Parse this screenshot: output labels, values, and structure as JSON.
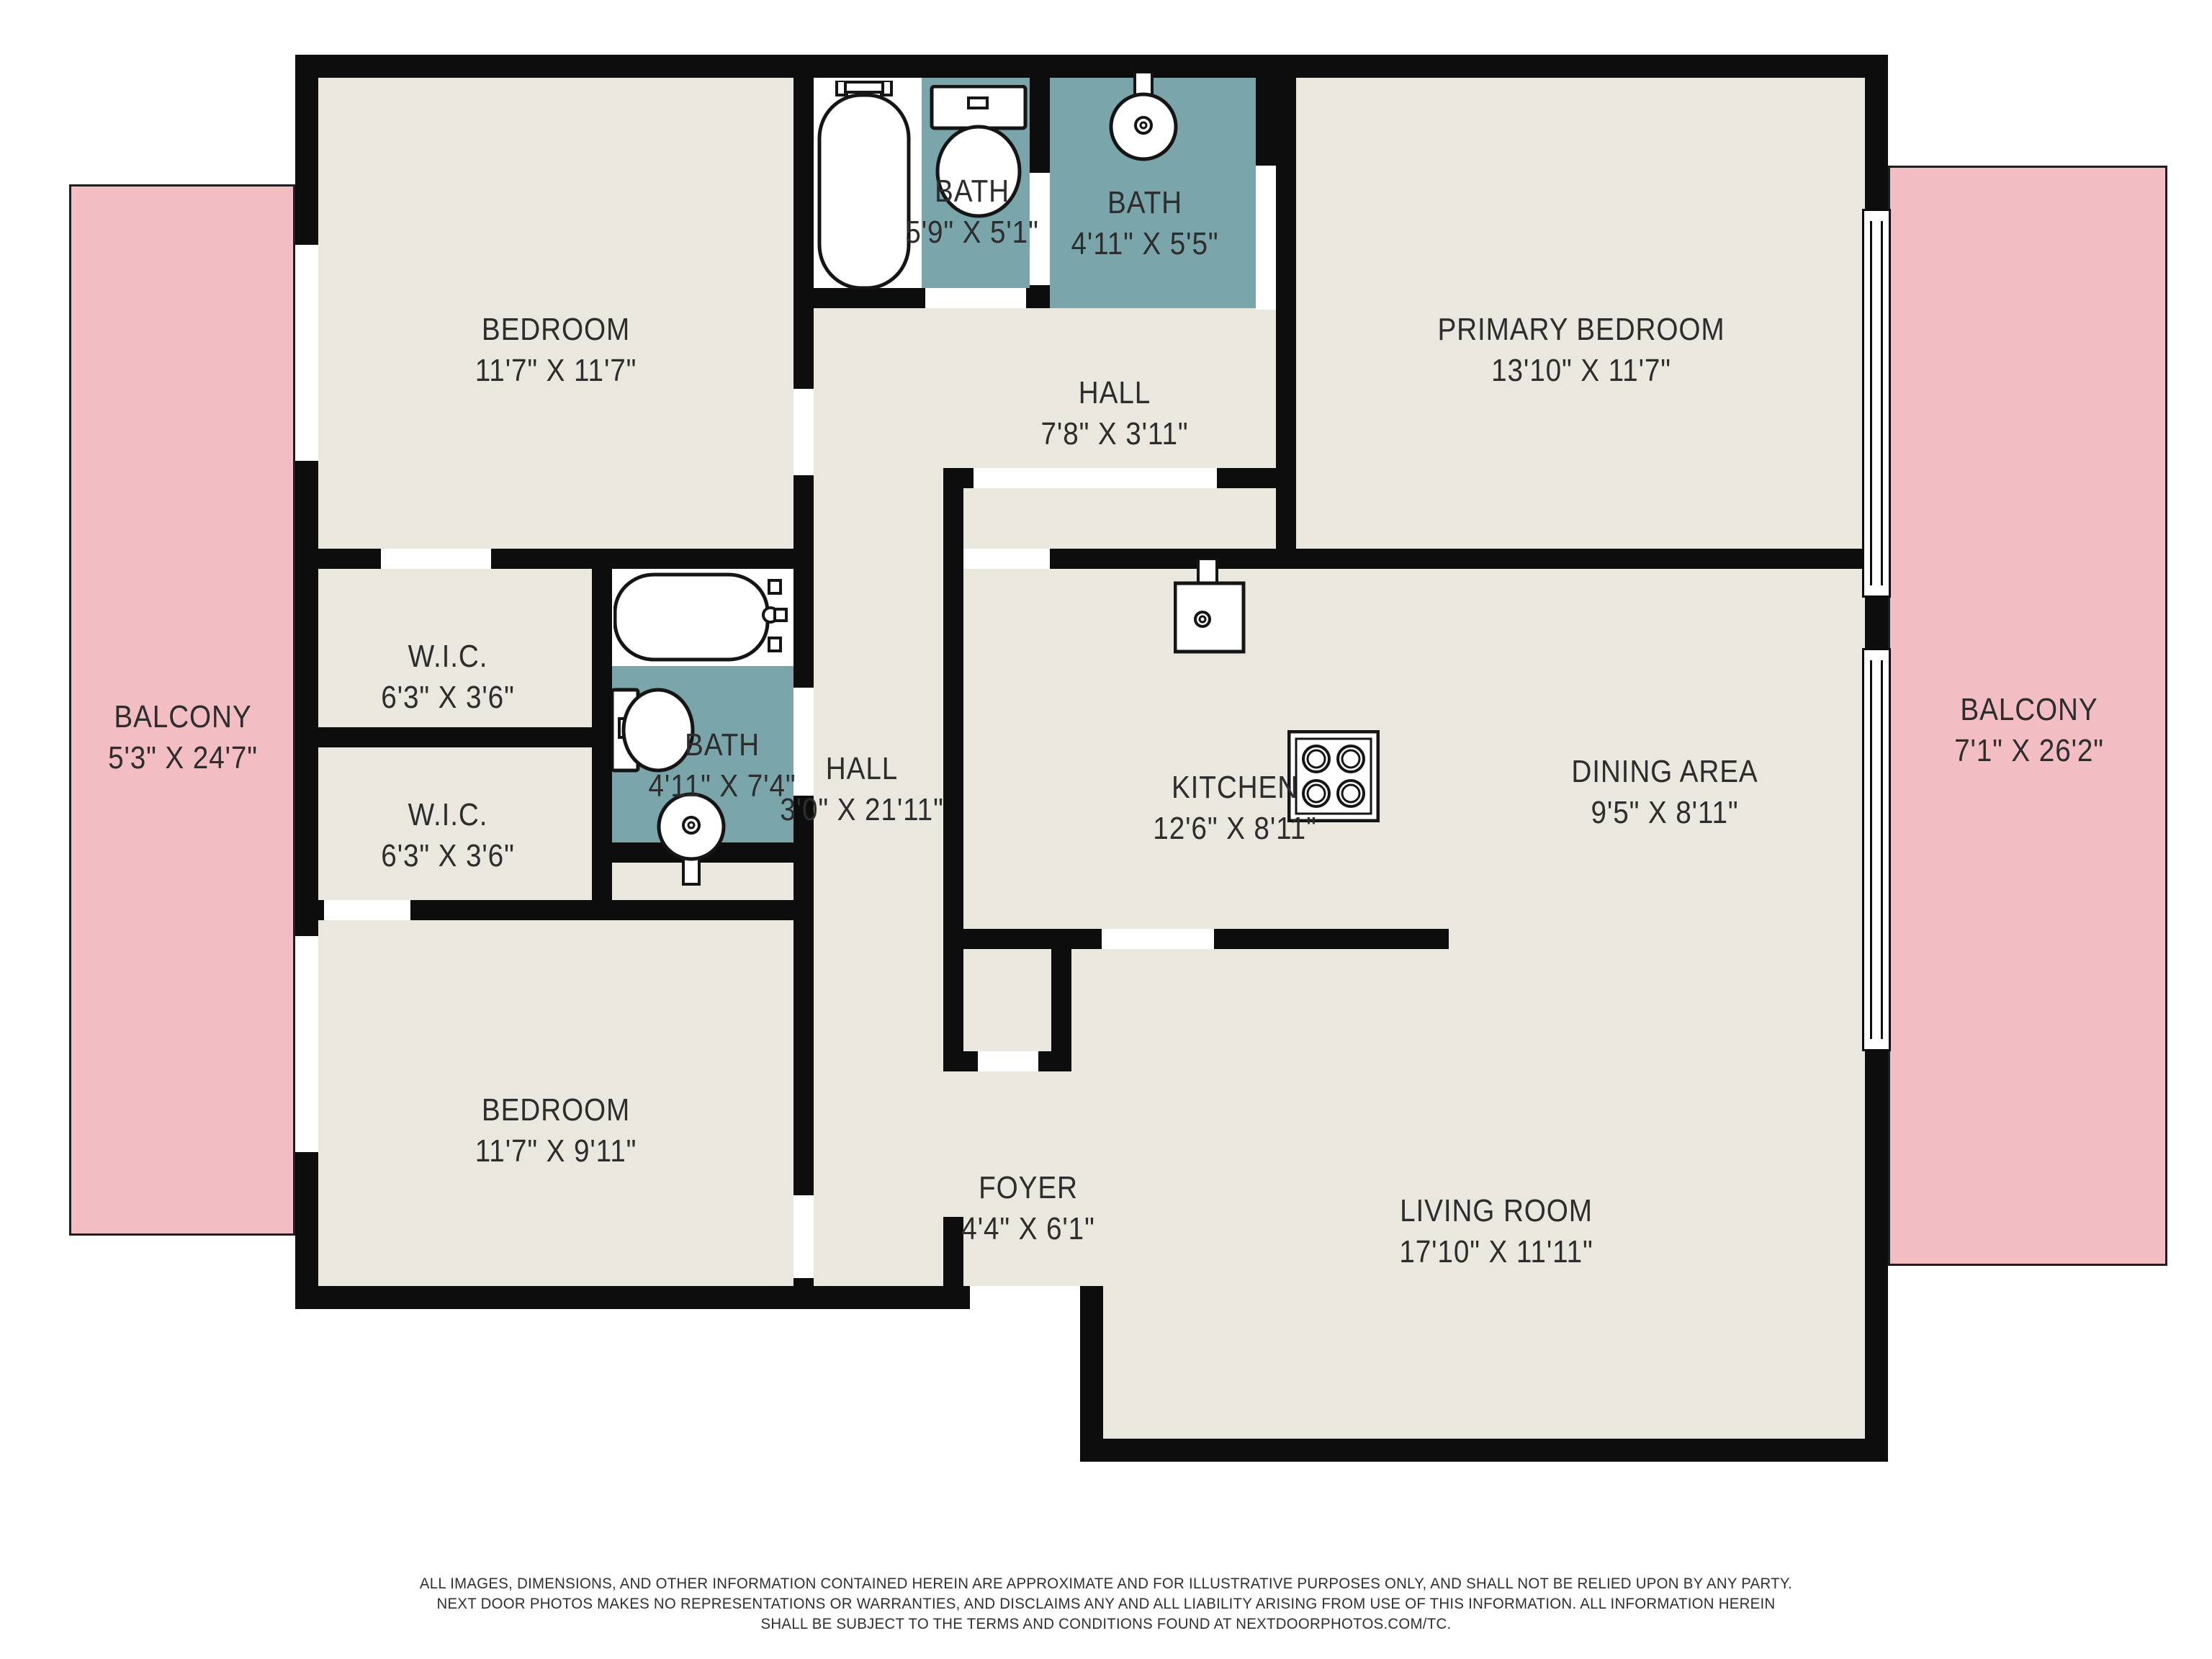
{
  "colors": {
    "floor": "#e9e7de",
    "bath": "#7aa6ab",
    "balcony": "#f2bdc3",
    "wall": "#0d0d0d",
    "text": "#2d2d2d"
  },
  "rooms": {
    "bedroom_top": {
      "name": "BEDROOM",
      "dims": "11'7\" X 11'7\""
    },
    "bath_top_1": {
      "name": "BATH",
      "dims": "5'9\" X 5'1\""
    },
    "bath_top_2": {
      "name": "BATH",
      "dims": "4'11\" X 5'5\""
    },
    "primary_bedroom": {
      "name": "PRIMARY BEDROOM",
      "dims": "13'10\" X 11'7\""
    },
    "hall_top": {
      "name": "HALL",
      "dims": "7'8\" X 3'11\""
    },
    "wic_1": {
      "name": "W.I.C.",
      "dims": "6'3\" X 3'6\""
    },
    "wic_2": {
      "name": "W.I.C.",
      "dims": "6'3\" X 3'6\""
    },
    "bath_middle": {
      "name": "BATH",
      "dims": "4'11\" X 7'4\""
    },
    "hall_main": {
      "name": "HALL",
      "dims": "3'0\" X 21'11\""
    },
    "kitchen": {
      "name": "KITCHEN",
      "dims": "12'6\" X 8'11\""
    },
    "dining": {
      "name": "DINING AREA",
      "dims": "9'5\" X 8'11\""
    },
    "bedroom_bottom": {
      "name": "BEDROOM",
      "dims": "11'7\" X 9'11\""
    },
    "foyer": {
      "name": "FOYER",
      "dims": "4'4\" X 6'1\""
    },
    "living_room": {
      "name": "LIVING ROOM",
      "dims": "17'10\" X 11'11\""
    },
    "balcony_left": {
      "name": "BALCONY",
      "dims": "5'3\" X 24'7\""
    },
    "balcony_right": {
      "name": "BALCONY",
      "dims": "7'1\" X 26'2\""
    }
  },
  "fixtures": [
    {
      "icon": "bathtub-icon",
      "room": "bath_top_1"
    },
    {
      "icon": "toilet-icon",
      "room": "bath_top_1"
    },
    {
      "icon": "sink-icon",
      "room": "bath_top_2"
    },
    {
      "icon": "bathtub-icon",
      "room": "bath_middle"
    },
    {
      "icon": "toilet-icon",
      "room": "bath_middle"
    },
    {
      "icon": "sink-icon",
      "room": "bath_middle"
    },
    {
      "icon": "kitchen-sink-icon",
      "room": "kitchen"
    },
    {
      "icon": "stove-icon",
      "room": "kitchen"
    }
  ],
  "disclaimer": {
    "lines": [
      "ALL IMAGES, DIMENSIONS, AND OTHER INFORMATION CONTAINED HEREIN ARE APPROXIMATE AND FOR ILLUSTRATIVE PURPOSES ONLY, AND SHALL NOT BE RELIED UPON BY ANY PARTY.",
      "NEXT DOOR PHOTOS MAKES NO REPRESENTATIONS OR WARRANTIES, AND DISCLAIMS ANY AND ALL LIABILITY ARISING FROM USE OF THIS INFORMATION. ALL INFORMATION HEREIN",
      "SHALL BE SUBJECT TO THE TERMS AND CONDITIONS FOUND AT NEXTDOORPHOTOS.COM/TC."
    ]
  }
}
